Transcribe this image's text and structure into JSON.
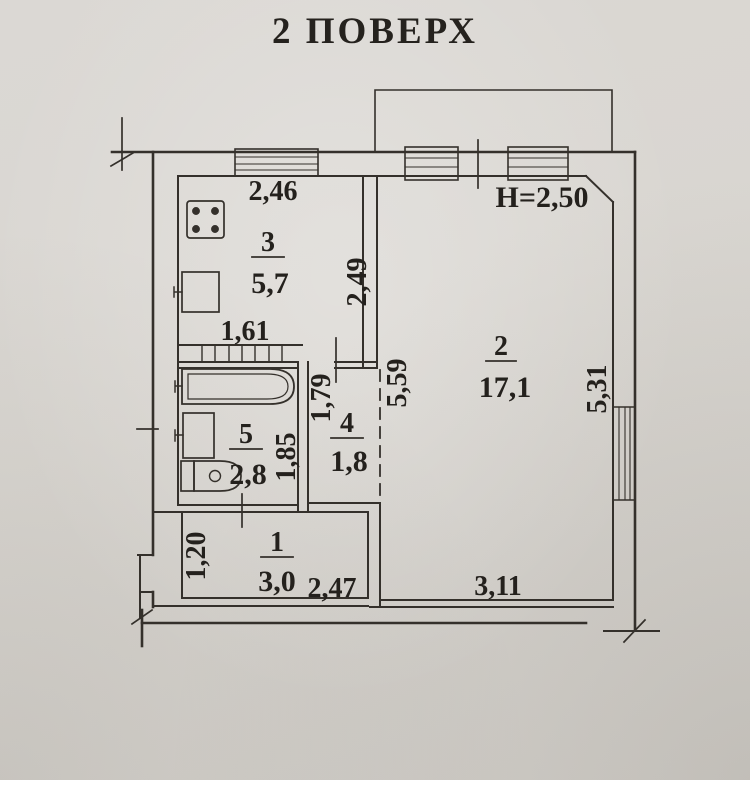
{
  "title": "2 ПОВЕРХ",
  "plan": {
    "height_note": "H=2,50",
    "rooms": {
      "entry": {
        "number": "1",
        "area": "3,0"
      },
      "living": {
        "number": "2",
        "area": "17,1"
      },
      "kitchen": {
        "number": "3",
        "area": "5,7"
      },
      "hall": {
        "number": "4",
        "area": "1,8"
      },
      "bathroom": {
        "number": "5",
        "area": "2,8"
      }
    },
    "dims": {
      "kitchen_width": "2,46",
      "kitchen_depth": "2,49",
      "bath_block_width": "1,61",
      "living_left_depth": "5,59",
      "bathroom_depth": "1,85",
      "hall_depth": "1,79",
      "living_right_depth": "5,31",
      "entry_door": "1,20",
      "entry_width": "2,47",
      "living_width": "3,11"
    },
    "colors": {
      "paper": "#d9d6d1",
      "ink": "#34302b"
    }
  }
}
